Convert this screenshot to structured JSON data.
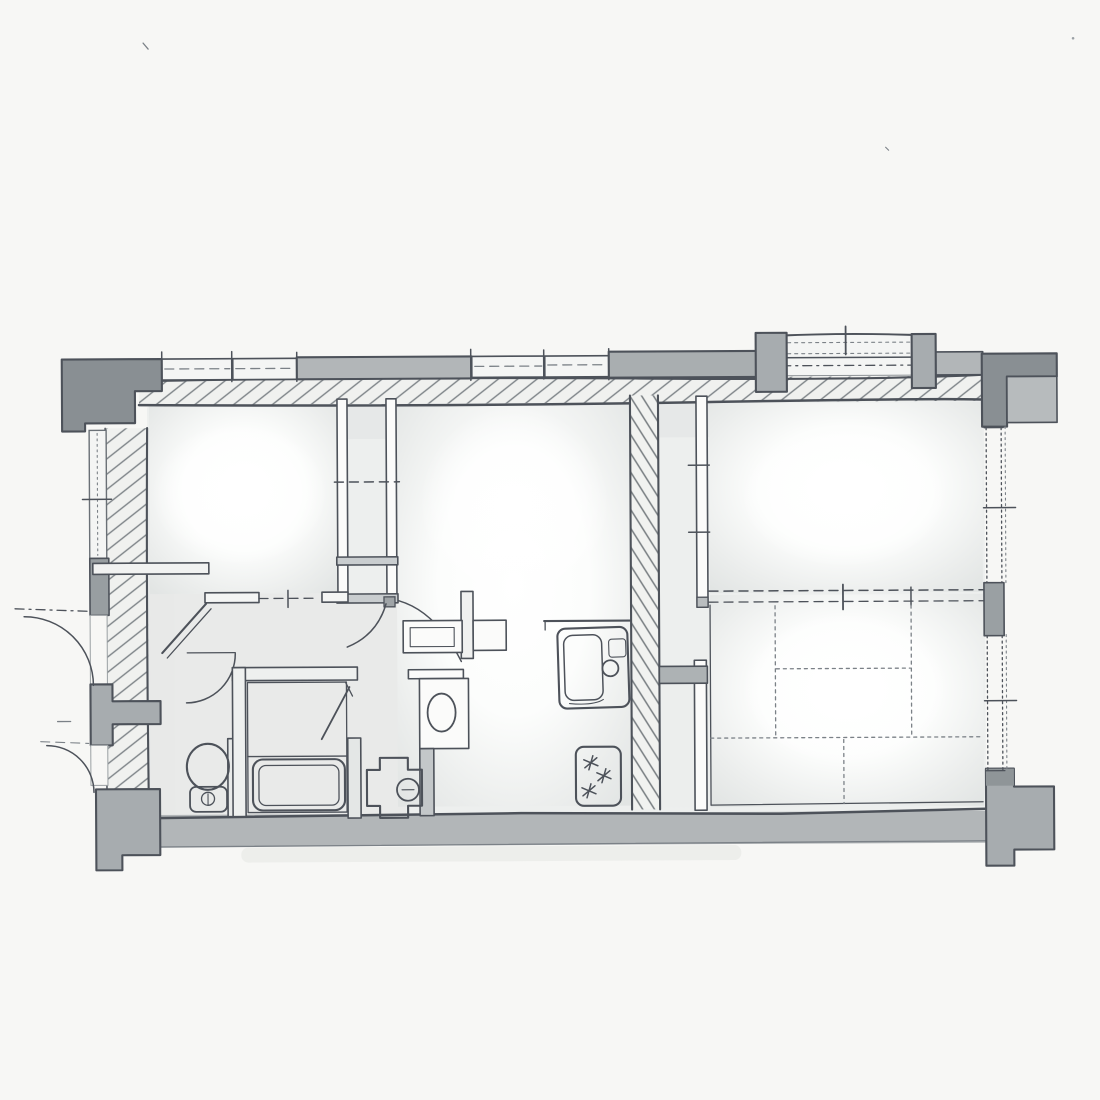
{
  "scene": {
    "kind": "hand-drawn architectural floor plan sketch",
    "medium": "pencil line work with grey watercolor wash on white paper",
    "visible_text": "none"
  },
  "palette": {
    "paper": "#f7f7f5",
    "pencil": "#4d525a",
    "pencilSoft": "#7b8187",
    "wallGrey": "#b2b6b8",
    "blockDark": "#898f93",
    "blockMid": "#a7acaf",
    "hatchLine": "#7d8387",
    "washLight": "#eef0ef",
    "washMid": "#dfe2e1",
    "windowFill": "#f4f5f4"
  },
  "plan": {
    "shape": "wide rectangle with heavy corner columns at all four corners",
    "north_side": [
      "window strip segments",
      "solid wall strips",
      "balcony slab with railing lines and two posts",
      "hatched main wall"
    ],
    "west_side": [
      "window with sill tick",
      "solid pier",
      "entrance door swinging outward",
      "partition block",
      "service door swinging outward"
    ],
    "east_side": [
      "window",
      "solid pier",
      "window",
      "two sill ticks"
    ],
    "south_side": [
      "continuous solid wall band"
    ],
    "rooms": [
      {
        "id": "bedroom-northwest",
        "features": [
          "closet strip with dashed divider",
          "sliding-door opening to hall"
        ]
      },
      {
        "id": "dining-kitchen-center",
        "features": [
          "hatched service duct",
          "kitchen sink unit",
          "gas stove",
          "counter edge line"
        ]
      },
      {
        "id": "room-northeast",
        "features": [
          "faces balcony",
          "jamb ticks on west wall"
        ]
      },
      {
        "id": "tatami-room-southeast",
        "tatami_mats": 6,
        "features": [
          "dashed sliding partition",
          "tatami mat grid"
        ]
      },
      {
        "id": "hall-center-west",
        "features": [
          "two door swing arcs",
          "small cabinet with inner line"
        ]
      },
      {
        "id": "entry-genkan-west",
        "features": [
          "diagonal step line"
        ]
      },
      {
        "id": "toilet-room-southwest",
        "features": [
          "toilet bowl with tank circle"
        ]
      },
      {
        "id": "bathroom-south",
        "features": [
          "double-line bathtub",
          "diagonal door leaf"
        ]
      },
      {
        "id": "washroom-south-center",
        "features": [
          "washbasin oval",
          "washing-machine pan cross",
          "low grey wall"
        ]
      }
    ],
    "fixtures": [
      "toilet",
      "bathtub",
      "washbasin",
      "washing-machine",
      "kitchen-sink",
      "gas-stove-3-burners",
      "refrigerator-recess-band"
    ],
    "door_arcs": 5,
    "burner_star_marks": 3,
    "tatami_grid_lines": {
      "verticals": 3,
      "horizontals": 2
    }
  }
}
